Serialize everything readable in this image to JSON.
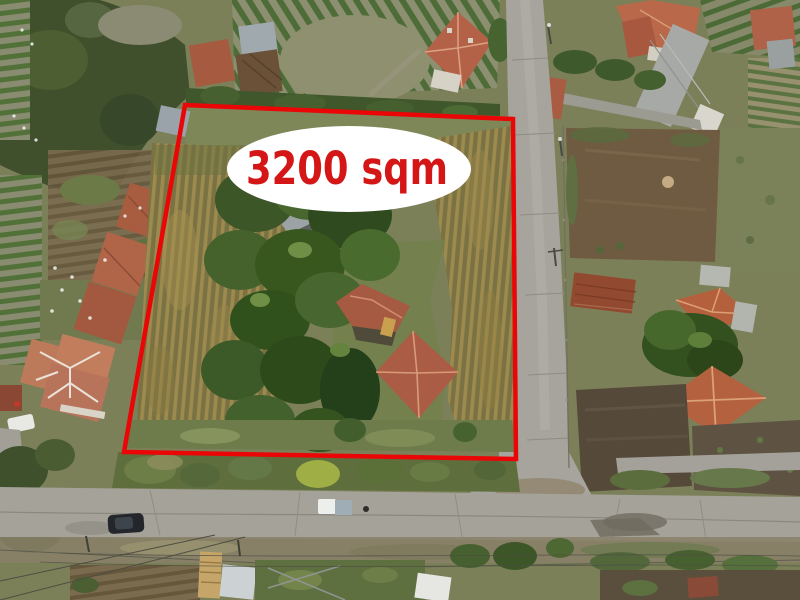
{
  "annotation": {
    "area_label": "3200 sqm",
    "boundary_color": "#ea0606",
    "bubble_color": "#ffffff",
    "text_color": "#d51616"
  },
  "scene": {
    "kind": "aerial-drone-photo-of-land-plot-for-sale",
    "features": [
      "red-plot-boundary",
      "area-label-bubble",
      "cornfield-inside-plot",
      "farmhouse-with-red-tile-roof",
      "tree-cluster",
      "vertical-street-right",
      "horizontal-street-bottom",
      "neighbor-houses",
      "vineyards",
      "dirt-gardens",
      "parked-dark-car",
      "parked-white-vehicle",
      "power-lines",
      "sheds"
    ]
  }
}
